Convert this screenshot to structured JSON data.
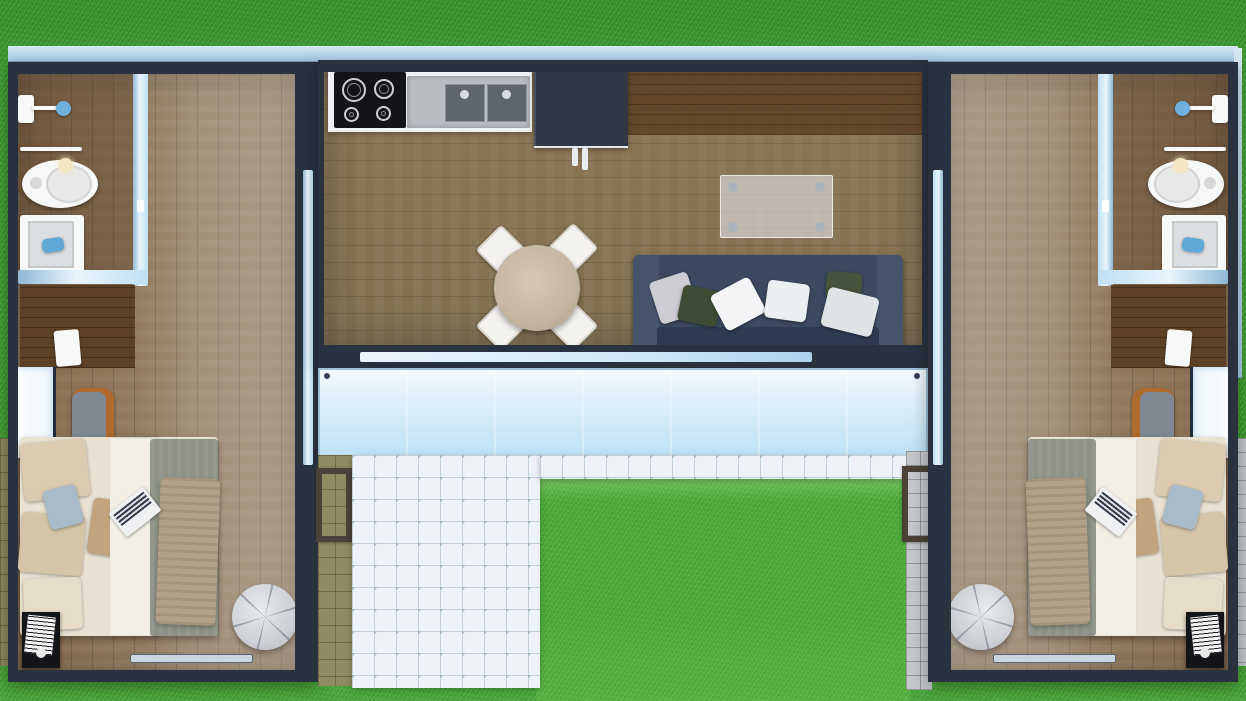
{
  "scene": {
    "type": "3d-floor-plan-top-down-render",
    "description": "Twin bedroom container units flanking a central kitchen-living module, joined by a frosted glass deck, set on a grass lawn",
    "image_width": 1246,
    "image_height": 701,
    "visible_text": "none"
  },
  "colors": {
    "grass": "#42a034",
    "grassBright": "#54bb40",
    "wall": "#2a3240",
    "wallDark": "#1f2735",
    "glass": "#a9cde8",
    "glassLight": "#cfe8f8",
    "deck": "#bfe2f6",
    "floorWarm": "#8f7050",
    "floorGray": "#ab9e8c",
    "floorCenter": "#93805f",
    "walnut": "#5d4126",
    "counter": "#eef0f2",
    "cooktop": "#131419",
    "sinkSteel": "#b9bdc2",
    "basin": "#5f656d",
    "fridge": "#313845",
    "sofa": "#3c4961",
    "sofaDark": "#2e3a52",
    "sofaArm": "#46536b",
    "pillowGreen": "#3e4a33",
    "pillowWhite": "#f4f4f6",
    "pillowGray": "#ccccd2",
    "tableWood": "#c6b8a2",
    "chairWhite": "#f3f2ee",
    "glassTable": "rgba(236,241,245,0.55)",
    "bedSheet": "#e9e2d2",
    "duvet": "#f3efe4",
    "blanket": "#8d9285",
    "throw": "#b2a088",
    "pillowBeige": "#dccbb0",
    "pillowTan": "#c1a37d",
    "pillowBlue": "#a9bac9",
    "pouf": "#cfd2d6",
    "deskChairWood": "#b06a2e",
    "deskChairSeat": "#7f8893",
    "nightstand": "#141519",
    "tileOlive": "#8f8a60",
    "tileWhite": "#eef2f6",
    "tileGray": "#c4c8ca",
    "matFrame": "#4a4238",
    "fixtureWhite": "#f7f8f8",
    "showerBlue": "#6fb0dd",
    "towelBlue": "#5fa8d8"
  },
  "inventory": {
    "left_unit": [
      "shower-fixture",
      "wall-shelf",
      "toilet",
      "bathroom-sink",
      "blue-towel",
      "glass-partition",
      "walnut-desk",
      "papers",
      "desk-chair",
      "west-window",
      "double-bed",
      "beige-pillows",
      "blue-gray-pillow",
      "tan-pillow",
      "white-duvet",
      "gray-blanket",
      "tan-throw",
      "laptop",
      "nightstand",
      "book-stack",
      "pouf",
      "door-threshold",
      "glass-door-east"
    ],
    "center_module": [
      "induction-cooktop-4-burners",
      "double-basin-sink",
      "white-counter",
      "refrigerator-2-handles",
      "round-dining-table",
      "4-white-chairs",
      "glass-console-table",
      "navy-sofa",
      "6-sofa-pillows",
      "south-window-bar",
      "frosted-glass-deck"
    ],
    "right_unit": "mirror image of left_unit",
    "outdoor": [
      "roof-edge-strip",
      "right-roof-fascia",
      "olive-tile-walkway-left",
      "white-tile-patio-L",
      "gray-tile-walkway-right",
      "two-doormats",
      "lawn"
    ]
  }
}
